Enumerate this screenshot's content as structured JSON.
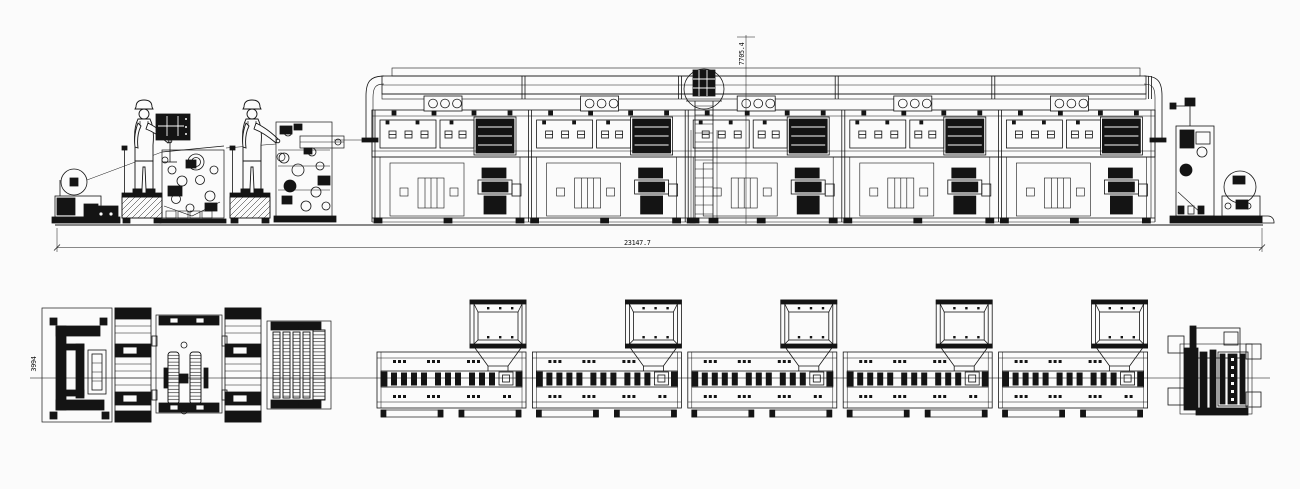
{
  "drawing": {
    "palette": {
      "ink": "#141414",
      "background": "#fbfbfb",
      "centerline": "#555555"
    },
    "oven_modules": {
      "count": 5
    },
    "operators": {
      "count": 2
    },
    "dimensions": {
      "overall_length": "23147.7",
      "overall_height": "7705.4",
      "plan_width": "3994"
    }
  }
}
